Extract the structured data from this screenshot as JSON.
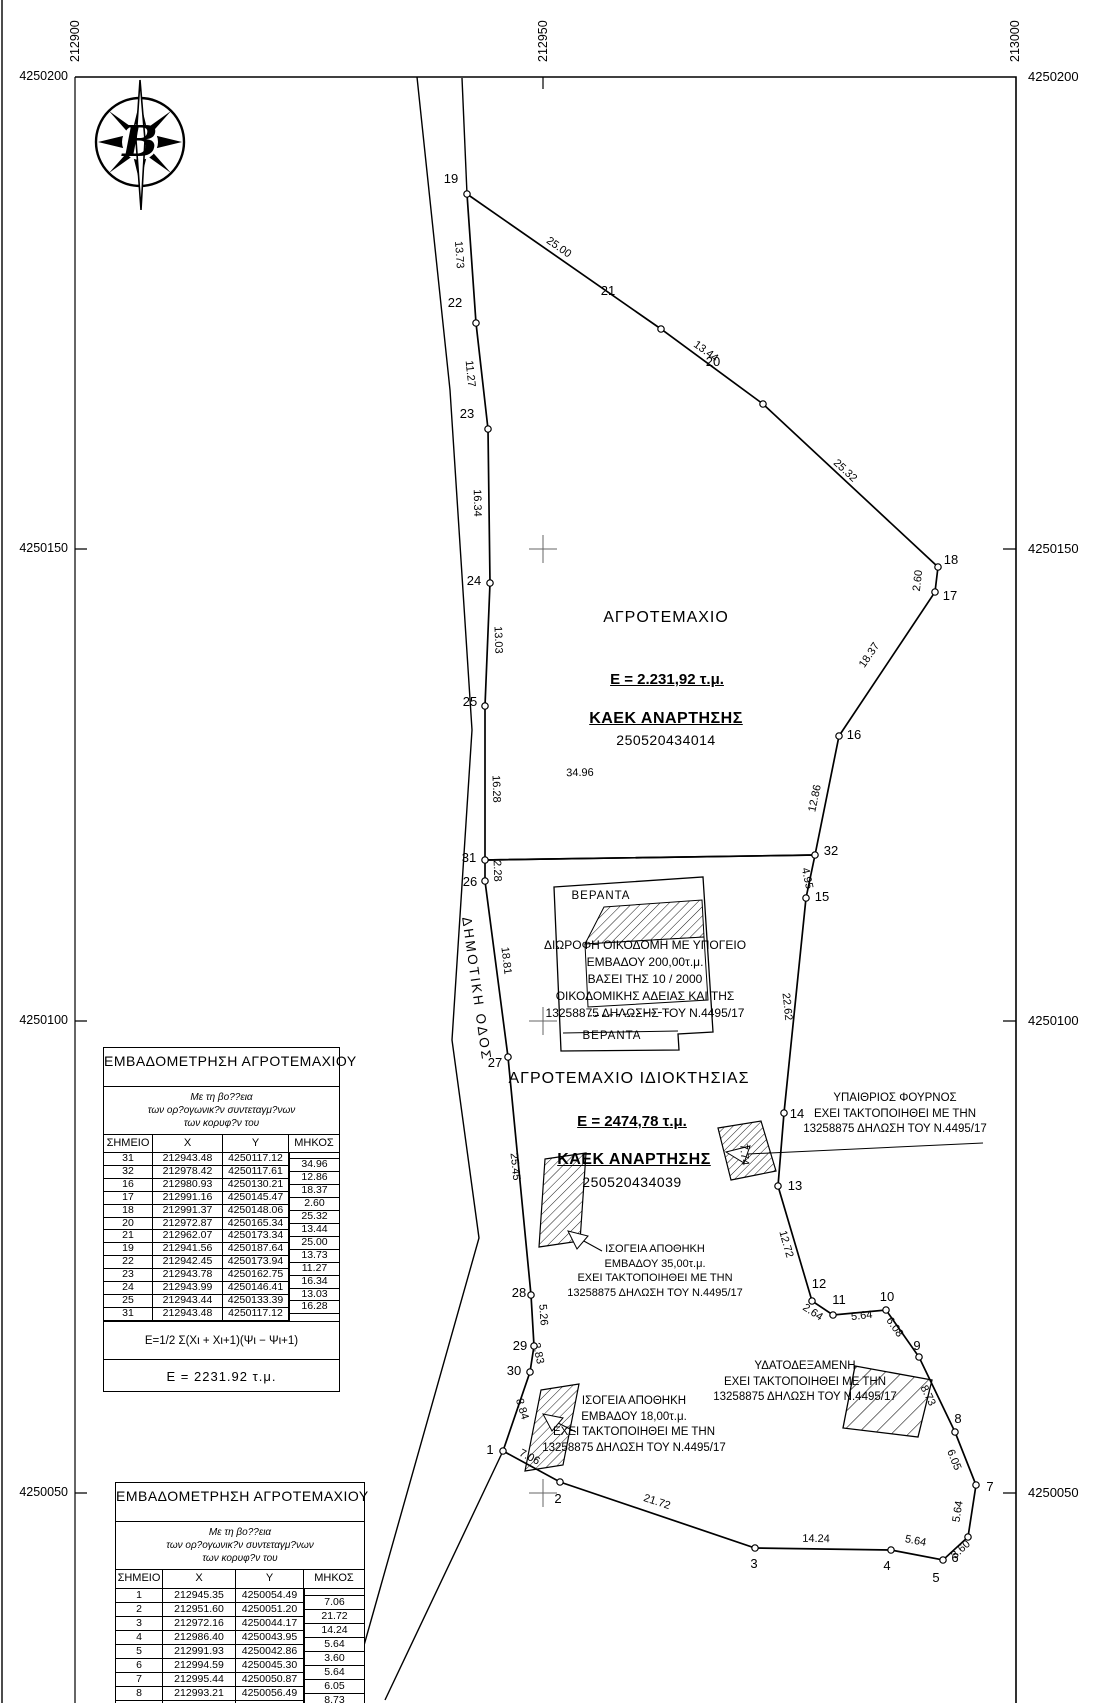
{
  "grid": {
    "x_labels": [
      {
        "text": "212900",
        "px": 75
      },
      {
        "text": "212950",
        "px": 543
      },
      {
        "text": "213000",
        "px": 1015
      }
    ],
    "y_labels": [
      {
        "text": "4250200",
        "px": 77
      },
      {
        "text": "4250150",
        "px": 549
      },
      {
        "text": "4250100",
        "px": 1021
      },
      {
        "text": "4250050",
        "px": 1493
      }
    ]
  },
  "north_arrow": {
    "letter": "Β"
  },
  "road_label": "ΔΗΜΟΤΙΚΗ ΟΔΟΣ",
  "parcels": {
    "north": {
      "title": "ΑΓΡΟΤΕΜΑΧΙΟ",
      "area": "Ε = 2.231,92 τ.μ.",
      "kaek_label": "ΚΑΕΚ ΑΝΑΡΤΗΣΗΣ",
      "kaek": "250520434014"
    },
    "south": {
      "title": "ΑΓΡΟΤΕΜΑΧΙΟ ΙΔΙΟΚΤΗΣΙΑΣ",
      "area": "Ε = 2474,78 τ.μ.",
      "kaek_label": "ΚΑΕΚ ΑΝΑΡΤΗΣΗΣ",
      "kaek": "250520434039"
    }
  },
  "annotations": {
    "veranda_top": "ΒΕΡΑΝΤΑ",
    "veranda_bottom": "ΒΕΡΑΝΤΑ",
    "house": [
      "ΔΙΩΡΟΦΗ ΟΙΚΟΔΟΜΗ ΜΕ ΥΠΟΓΕΙΟ",
      "ΕΜΒΑΔΟΥ 200,00τ.μ.",
      "ΒΑΣΕΙ ΤΗΣ 10 / 2000",
      "ΟΙΚΟΔΟΜΙΚΗΣ ΑΔΕΙΑΣ ΚΑΙ ΤΗΣ",
      "13258875 ΔΗΛΩΣΗΣ ΤΟΥ Ν.4495/17"
    ],
    "oven": [
      "ΥΠΑΙΘΡΙΟΣ ΦΟΥΡΝΟΣ",
      "ΕΧΕΙ ΤΑΚΤΟΠΟΙΗΘΕΙ ΜΕ ΤΗΝ",
      "13258875 ΔΗΛΩΣΗ ΤΟΥ Ν.4495/17"
    ],
    "tank": [
      "ΥΔΑΤΟΔΕΞΑΜΕΝΗ",
      "ΕΧΕΙ ΤΑΚΤΟΠΟΙΗΘΕΙ ΜΕ ΤΗΝ",
      "13258875 ΔΗΛΩΣΗ ΤΟΥ Ν.4495/17"
    ],
    "storage35": [
      "ΙΣΟΓΕΙΑ ΑΠΟΘΗΚΗ",
      "ΕΜΒΑΔΟΥ 35,00τ.μ.",
      "ΕΧΕΙ ΤΑΚΤΟΠΟΙΗΘΕΙ ΜΕ ΤΗΝ",
      "13258875 ΔΗΛΩΣΗ ΤΟΥ Ν.4495/17"
    ],
    "storage18": [
      "ΙΣΟΓΕΙΑ ΑΠΟΘΗΚΗ",
      "ΕΜΒΑΔΟΥ 18,00τ.μ.",
      "ΕΧΕΙ ΤΑΚΤΟΠΟΙΗΘΕΙ ΜΕ ΤΗΝ",
      "13258875 ΔΗΛΩΣΗ ΤΟΥ Ν.4495/17"
    ]
  },
  "map": {
    "vertices": [
      {
        "label": "31",
        "x": 485,
        "y": 860,
        "lx": 469,
        "ly": 858
      },
      {
        "label": "32",
        "x": 815,
        "y": 855,
        "lx": 831,
        "ly": 851
      },
      {
        "label": "16",
        "x": 839,
        "y": 736,
        "lx": 854,
        "ly": 735
      },
      {
        "label": "17",
        "x": 935,
        "y": 592,
        "lx": 950,
        "ly": 596
      },
      {
        "label": "18",
        "x": 938,
        "y": 567,
        "lx": 951,
        "ly": 560
      },
      {
        "label": "20",
        "x": 763,
        "y": 404,
        "lx": 713,
        "ly": 362
      },
      {
        "label": "21",
        "x": 661,
        "y": 329,
        "lx": 608,
        "ly": 291
      },
      {
        "label": "19",
        "x": 467,
        "y": 194,
        "lx": 451,
        "ly": 179
      },
      {
        "label": "22",
        "x": 476,
        "y": 323,
        "lx": 455,
        "ly": 303
      },
      {
        "label": "23",
        "x": 488,
        "y": 429,
        "lx": 467,
        "ly": 414
      },
      {
        "label": "24",
        "x": 490,
        "y": 583,
        "lx": 474,
        "ly": 581
      },
      {
        "label": "25",
        "x": 485,
        "y": 706,
        "lx": 470,
        "ly": 702
      },
      {
        "label": "26",
        "x": 485,
        "y": 881,
        "lx": 470,
        "ly": 882
      },
      {
        "label": "27",
        "x": 508,
        "y": 1057,
        "lx": 495,
        "ly": 1063
      },
      {
        "label": "28",
        "x": 531,
        "y": 1295,
        "lx": 519,
        "ly": 1293
      },
      {
        "label": "29",
        "x": 534,
        "y": 1346,
        "lx": 520,
        "ly": 1346
      },
      {
        "label": "30",
        "x": 530,
        "y": 1372,
        "lx": 514,
        "ly": 1371
      },
      {
        "label": "1",
        "x": 503,
        "y": 1451,
        "lx": 490,
        "ly": 1450
      },
      {
        "label": "2",
        "x": 560,
        "y": 1482,
        "lx": 558,
        "ly": 1499
      },
      {
        "label": "3",
        "x": 755,
        "y": 1548,
        "lx": 754,
        "ly": 1564
      },
      {
        "label": "4",
        "x": 891,
        "y": 1550,
        "lx": 887,
        "ly": 1566
      },
      {
        "label": "5",
        "x": 943,
        "y": 1560,
        "lx": 936,
        "ly": 1578
      },
      {
        "label": "6",
        "x": 968,
        "y": 1537,
        "lx": 955,
        "ly": 1558
      },
      {
        "label": "7",
        "x": 976,
        "y": 1485,
        "lx": 990,
        "ly": 1487
      },
      {
        "label": "8",
        "x": 955,
        "y": 1432,
        "lx": 958,
        "ly": 1419
      },
      {
        "label": "9",
        "x": 919,
        "y": 1357,
        "lx": 917,
        "ly": 1346
      },
      {
        "label": "10",
        "x": 886,
        "y": 1310,
        "lx": 887,
        "ly": 1297
      },
      {
        "label": "11",
        "x": 833,
        "y": 1315,
        "lx": 839,
        "ly": 1300
      },
      {
        "label": "12",
        "x": 812,
        "y": 1301,
        "lx": 819,
        "ly": 1284
      },
      {
        "label": "13",
        "x": 778,
        "y": 1186,
        "lx": 795,
        "ly": 1186
      },
      {
        "label": "14",
        "x": 784,
        "y": 1113,
        "lx": 797,
        "ly": 1114
      },
      {
        "label": "15",
        "x": 806,
        "y": 898,
        "lx": 822,
        "ly": 897
      }
    ],
    "segments": [
      {
        "len": "25.00",
        "x": 557,
        "y": 250,
        "rot": 35
      },
      {
        "len": "13.44",
        "x": 704,
        "y": 354,
        "rot": 36
      },
      {
        "len": "25.32",
        "x": 843,
        "y": 473,
        "rot": 43
      },
      {
        "len": "2.60",
        "x": 921,
        "y": 581,
        "rot": -83
      },
      {
        "len": "18.37",
        "x": 872,
        "y": 657,
        "rot": -56
      },
      {
        "len": "12.86",
        "x": 818,
        "y": 799,
        "rot": -78
      },
      {
        "len": "34.96",
        "x": 580,
        "y": 776,
        "rot": -1
      },
      {
        "len": "13.73",
        "x": 456,
        "y": 255,
        "rot": 86
      },
      {
        "len": "11.27",
        "x": 467,
        "y": 374,
        "rot": 84
      },
      {
        "len": "16.34",
        "x": 474,
        "y": 503,
        "rot": 89
      },
      {
        "len": "13.03",
        "x": 495,
        "y": 640,
        "rot": 88
      },
      {
        "len": "16.28",
        "x": 493,
        "y": 789,
        "rot": 88
      },
      {
        "len": "2.28",
        "x": 494,
        "y": 871,
        "rot": 88
      },
      {
        "len": "18.81",
        "x": 503,
        "y": 961,
        "rot": 83
      },
      {
        "len": "25.45",
        "x": 512,
        "y": 1167,
        "rot": 84
      },
      {
        "len": "5.26",
        "x": 540,
        "y": 1315,
        "rot": 86
      },
      {
        "len": "2.83",
        "x": 535,
        "y": 1354,
        "rot": 78
      },
      {
        "len": "8.84",
        "x": 519,
        "y": 1410,
        "rot": 73
      },
      {
        "len": "7.06",
        "x": 528,
        "y": 1460,
        "rot": 27
      },
      {
        "len": "21.72",
        "x": 656,
        "y": 1505,
        "rot": 18
      },
      {
        "len": "14.24",
        "x": 816,
        "y": 1542,
        "rot": 1
      },
      {
        "len": "5.64",
        "x": 915,
        "y": 1544,
        "rot": 11
      },
      {
        "len": "3.60",
        "x": 963,
        "y": 1552,
        "rot": -43
      },
      {
        "len": "5.64",
        "x": 961,
        "y": 1512,
        "rot": -81
      },
      {
        "len": "6.05",
        "x": 951,
        "y": 1461,
        "rot": 68
      },
      {
        "len": "8.73",
        "x": 925,
        "y": 1397,
        "rot": 64
      },
      {
        "len": "6.08",
        "x": 892,
        "y": 1329,
        "rot": 55
      },
      {
        "len": "5.64",
        "x": 862,
        "y": 1319,
        "rot": -6
      },
      {
        "len": "2.64",
        "x": 811,
        "y": 1315,
        "rot": 33
      },
      {
        "len": "12.72",
        "x": 783,
        "y": 1245,
        "rot": 74
      },
      {
        "len": "7.74",
        "x": 741,
        "y": 1155,
        "rot": 85
      },
      {
        "len": "22.62",
        "x": 784,
        "y": 1007,
        "rot": 84
      },
      {
        "len": "4.95",
        "x": 804,
        "y": 879,
        "rot": 78
      }
    ]
  },
  "tables": [
    {
      "title": "ΕΜΒΑΔΟΜΕΤΡΗΣΗ ΑΓΡΟΤΕΜΑΧΙΟΥ",
      "subtitle": [
        "Με τη βο??εια",
        "των ορ?ογωνικ?ν συντεταγμ?νων",
        "των κορυφ?ν του"
      ],
      "headers": [
        "ΣΗΜΕΙΟ",
        "X",
        "Y",
        "ΜΗΚΟΣ"
      ],
      "rows": [
        {
          "p": "31",
          "x": "212943.48",
          "y": "4250117.12"
        },
        {
          "p": "32",
          "x": "212978.42",
          "y": "4250117.61"
        },
        {
          "p": "16",
          "x": "212980.93",
          "y": "4250130.21"
        },
        {
          "p": "17",
          "x": "212991.16",
          "y": "4250145.47"
        },
        {
          "p": "18",
          "x": "212991.37",
          "y": "4250148.06"
        },
        {
          "p": "20",
          "x": "212972.87",
          "y": "4250165.34"
        },
        {
          "p": "21",
          "x": "212962.07",
          "y": "4250173.34"
        },
        {
          "p": "19",
          "x": "212941.56",
          "y": "4250187.64"
        },
        {
          "p": "22",
          "x": "212942.45",
          "y": "4250173.94"
        },
        {
          "p": "23",
          "x": "212943.78",
          "y": "4250162.75"
        },
        {
          "p": "24",
          "x": "212943.99",
          "y": "4250146.41"
        },
        {
          "p": "25",
          "x": "212943.44",
          "y": "4250133.39"
        },
        {
          "p": "31",
          "x": "212943.48",
          "y": "4250117.12"
        }
      ],
      "lengths": [
        "34.96",
        "12.86",
        "18.37",
        "2.60",
        "25.32",
        "13.44",
        "25.00",
        "13.73",
        "11.27",
        "16.34",
        "13.03",
        "16.28"
      ],
      "formula": "Ε=1/2 Σ(Χι + Χι+1)(Ψι − Ψι+1)",
      "result": "Ε = 2231.92 τ.μ."
    },
    {
      "title": "ΕΜΒΑΔΟΜΕΤΡΗΣΗ ΑΓΡΟΤΕΜΑΧΙΟΥ",
      "subtitle": [
        "Με τη βο??εια",
        "των ορ?ογωνικ?ν συντεταγμ?νων",
        "των κορυφ?ν του"
      ],
      "headers": [
        "ΣΗΜΕΙΟ",
        "X",
        "Y",
        "ΜΗΚΟΣ"
      ],
      "rows": [
        {
          "p": "1",
          "x": "212945.35",
          "y": "4250054.49"
        },
        {
          "p": "2",
          "x": "212951.60",
          "y": "4250051.20"
        },
        {
          "p": "3",
          "x": "212972.16",
          "y": "4250044.17"
        },
        {
          "p": "4",
          "x": "212986.40",
          "y": "4250043.95"
        },
        {
          "p": "5",
          "x": "212991.93",
          "y": "4250042.86"
        },
        {
          "p": "6",
          "x": "212994.59",
          "y": "4250045.30"
        },
        {
          "p": "7",
          "x": "212995.44",
          "y": "4250050.87"
        },
        {
          "p": "8",
          "x": "212993.21",
          "y": "4250056.49"
        },
        {
          "p": "9",
          "x": "212989.44",
          "y": "4250064.37"
        }
      ],
      "lengths": [
        "7.06",
        "21.72",
        "14.24",
        "5.64",
        "3.60",
        "5.64",
        "6.05",
        "8.73"
      ],
      "formula": "",
      "result": ""
    }
  ]
}
